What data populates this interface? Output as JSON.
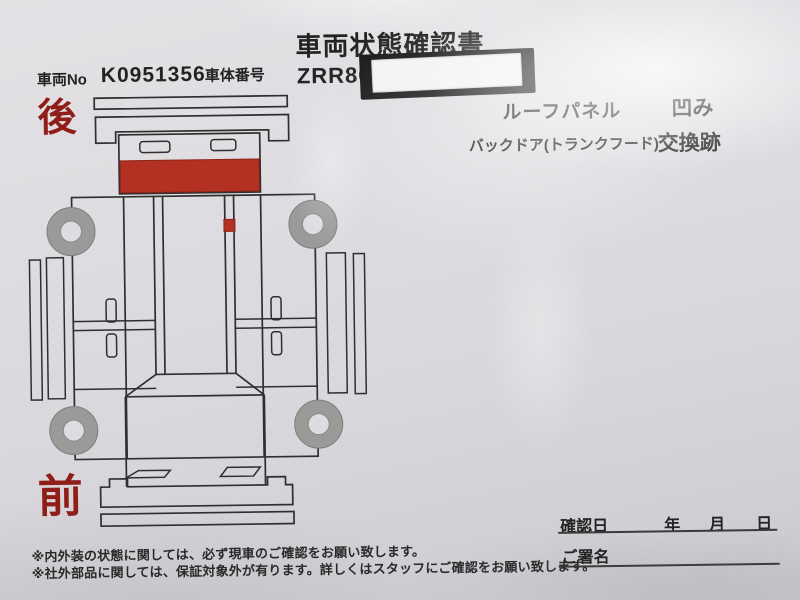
{
  "doc": {
    "title": "車両状態確認書",
    "vehicle_no": {
      "label": "車両No",
      "value": "K0951356"
    },
    "body_number": {
      "label": "車体番号",
      "value": "ZRR80-",
      "redacted": "white-sticker-over-black-marker"
    },
    "damage_notes": [
      {
        "part": "ルーフパネル",
        "condition": "凹み"
      },
      {
        "part": "バックドア(トランクフード)",
        "condition": "交換跡"
      }
    ],
    "diagram": {
      "rear_label": "後",
      "front_label": "前",
      "damage_markers": [
        "back-door-panel-full-width",
        "roof-right-rail-spot"
      ]
    },
    "confirmation": {
      "date_label": "確認日",
      "year_label": "年",
      "month_label": "月",
      "day_label": "日",
      "signature_label": "ご署名"
    },
    "footnotes": [
      "※内外装の状態に関しては、必ず現車のご確認をお願い致します。",
      "※社外部品に関しては、保証対象外が有ります。詳しくはスタッフにご確認をお願い致します。"
    ],
    "colors": {
      "paper": "#dedce0",
      "ink": "#232323",
      "diagram_line": "#2f2f2f",
      "damage_red": "#b23122",
      "label_red": "#8f1d18",
      "wheel_gray": "#9c9a99",
      "redaction_black": "#161616",
      "sticker_white": "#f5f3f1"
    }
  }
}
